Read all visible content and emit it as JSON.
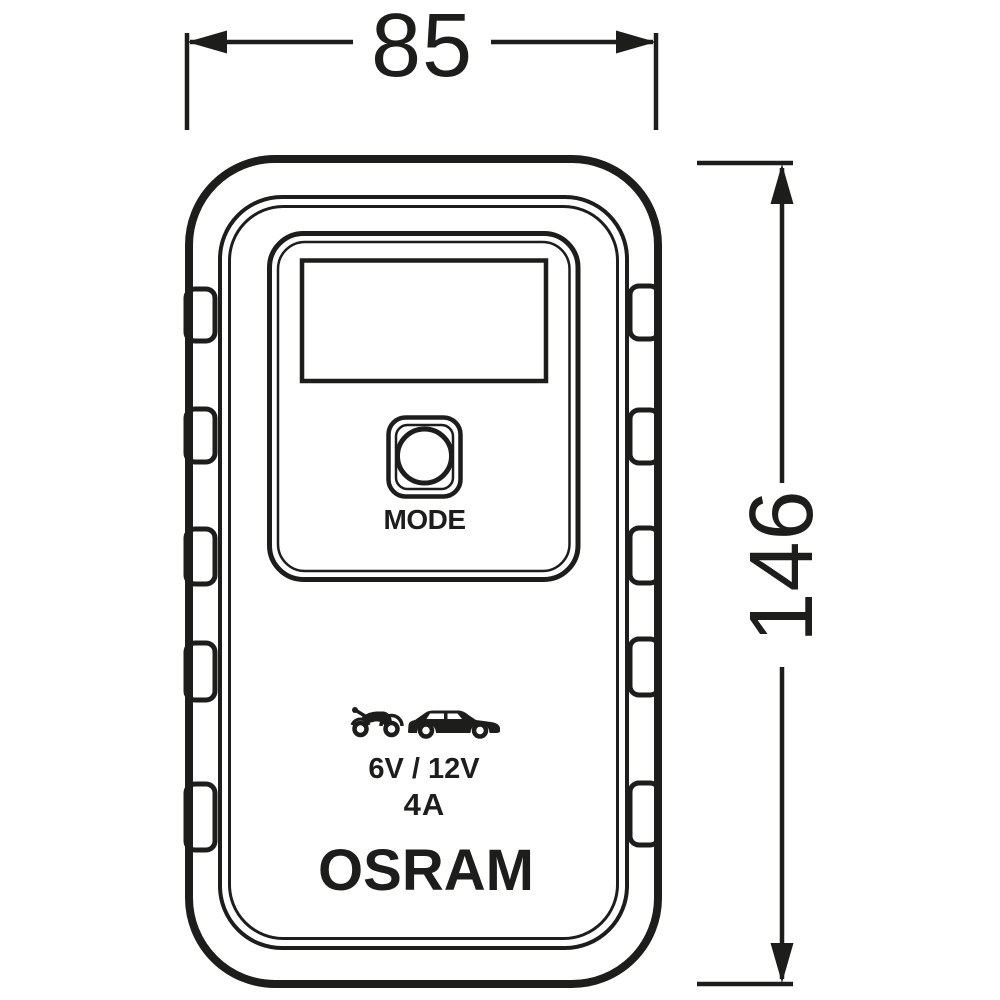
{
  "colors": {
    "ink": "#1d1d1b",
    "background": "#ffffff"
  },
  "dimensions": {
    "width": {
      "value": "85"
    },
    "height": {
      "value": "146"
    }
  },
  "device": {
    "mode_button": {
      "label": "MODE"
    },
    "markings": {
      "voltage": "6V / 12V",
      "current": "4A",
      "brand": "OSRAM"
    },
    "icons": [
      {
        "name": "motorcycle-icon"
      },
      {
        "name": "car-icon"
      }
    ]
  }
}
